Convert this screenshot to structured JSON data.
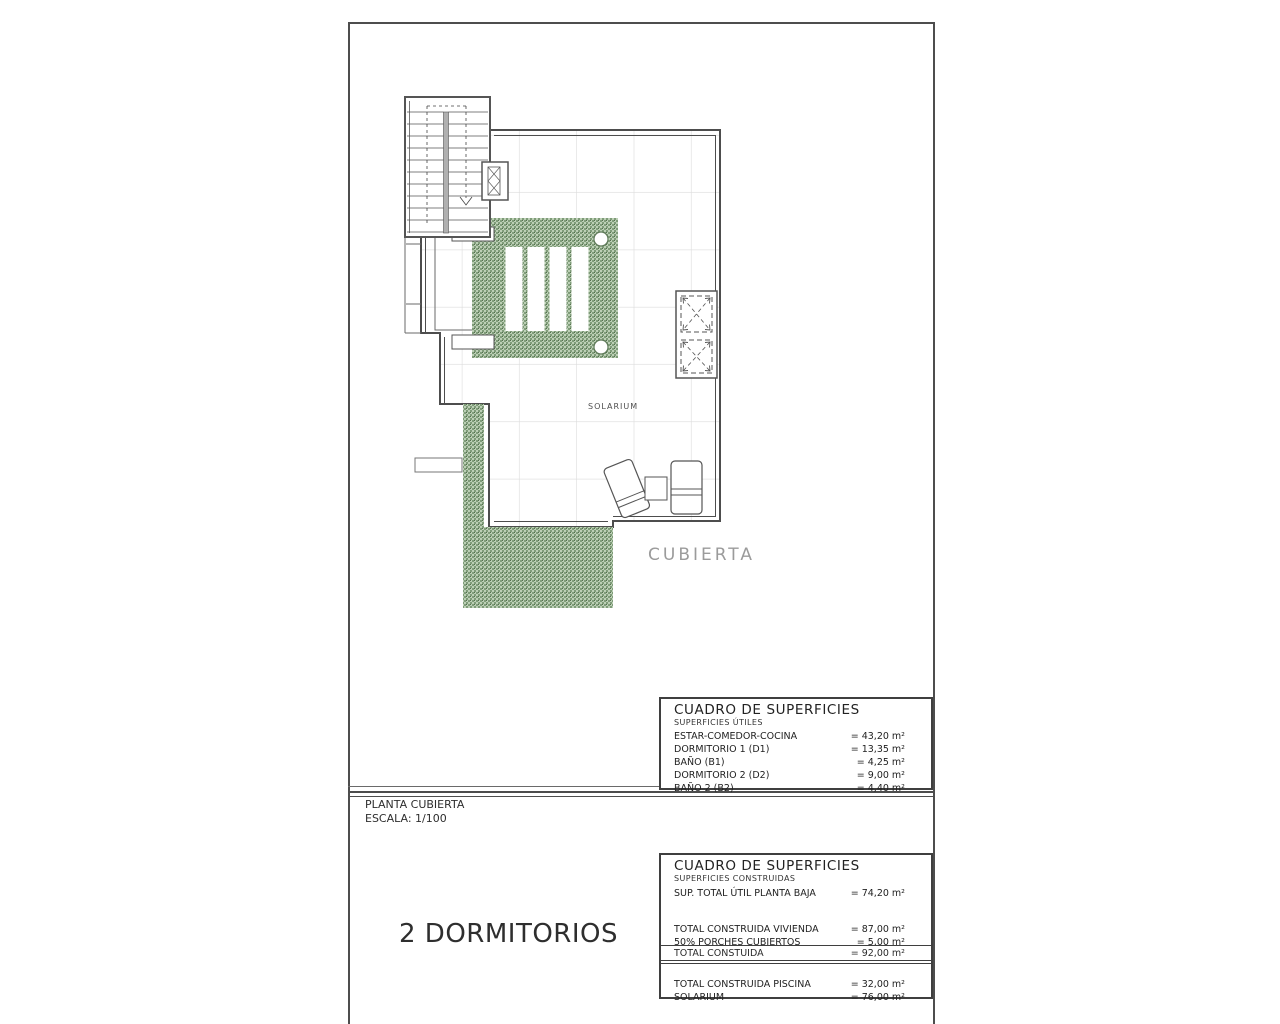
{
  "plan": {
    "solarium_label": "SOLARIUM",
    "cubierta_label": "CUBIERTA"
  },
  "title_block": {
    "plan_name": "PLANTA CUBIERTA",
    "scale": "ESCALA: 1/100",
    "variant": "2 DORMITORIOS"
  },
  "table_utiles": {
    "title": "CUADRO DE SUPERFICIES",
    "subtitle": "SUPERFICIES ÚTILES",
    "rows": [
      {
        "label": "ESTAR-COMEDOR-COCINA",
        "value": "= 43,20 m²"
      },
      {
        "label": "DORMITORIO 1 (D1)",
        "value": "= 13,35 m²"
      },
      {
        "label": "BAÑO (B1)",
        "value": "= 4,25 m²"
      },
      {
        "label": "DORMITORIO 2 (D2)",
        "value": "= 9,00 m²"
      },
      {
        "label": "BAÑO 2 (B2)",
        "value": "= 4,40 m²"
      }
    ]
  },
  "table_construidas": {
    "title": "CUADRO DE SUPERFICIES",
    "subtitle": "SUPERFICIES CONSTRUIDAS",
    "row_planta_baja": {
      "label": "SUP. TOTAL ÚTIL PLANTA BAJA",
      "value": "= 74,20 m²"
    },
    "rows_vivienda": [
      {
        "label": "TOTAL CONSTRUIDA VIVIENDA",
        "value": "= 87,00 m²"
      },
      {
        "label": "50% PORCHES CUBIERTOS",
        "value": "= 5,00 m²"
      }
    ],
    "row_total": {
      "label": "TOTAL CONSTUIDA",
      "value": "= 92,00 m²"
    },
    "rows_piscina": [
      {
        "label": "TOTAL CONSTRUIDA PISCINA",
        "value": "= 32,00 m²"
      },
      {
        "label": "SOLARIUM",
        "value": "= 76,00 m²"
      }
    ]
  },
  "colors": {
    "line": "#4d4d4d",
    "grid": "#dcdcdc",
    "green_light": "#bccfb5",
    "green_dark": "#7f9c79",
    "grey_label": "#9b9b9b"
  }
}
